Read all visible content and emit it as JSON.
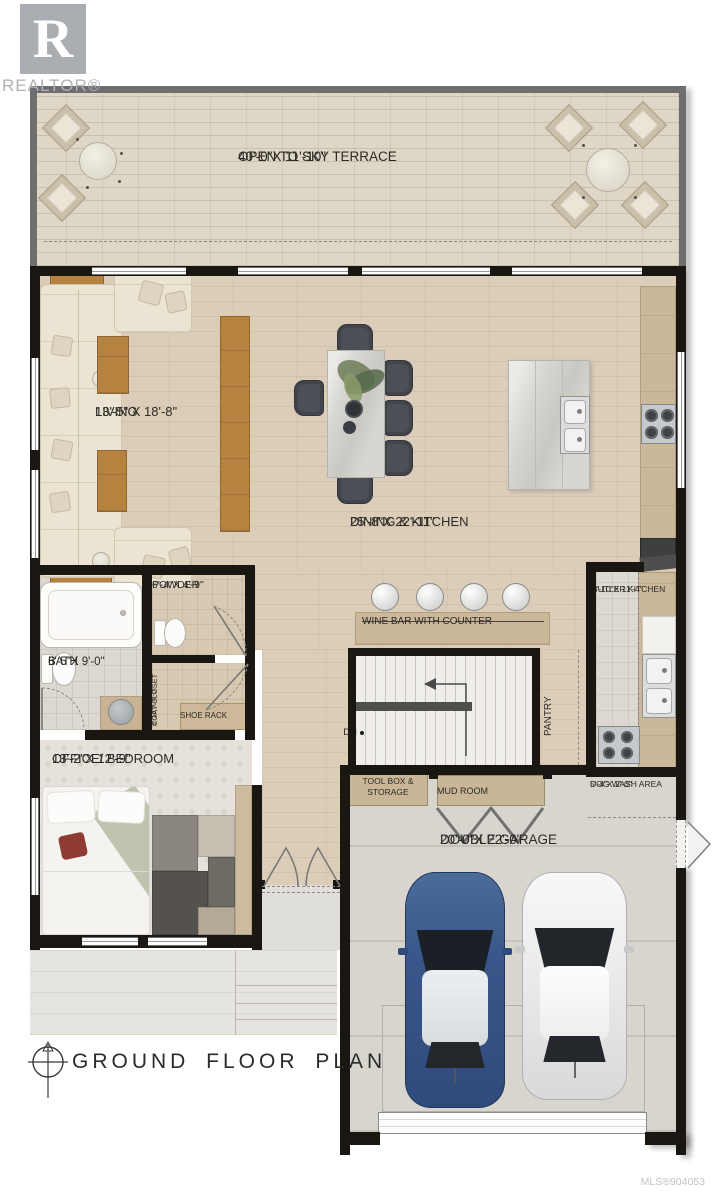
{
  "branding": {
    "logo_letter": "R",
    "realtor_text": "REALTOR®",
    "mls_text": "MLS®904053"
  },
  "title": {
    "plan_name": "GROUND FLOOR PLAN"
  },
  "rooms": {
    "terrace": {
      "name": "OPEN TO SKY TERRACE",
      "dims": "40'-0\"X 11'-10\""
    },
    "living": {
      "name": "LIVING",
      "dims": "13'-5\" X 18'-8\""
    },
    "dining_kitchen": {
      "name": "DINING & KITCHEN",
      "dims": "25'-8\"X 22'-11\""
    },
    "powder": {
      "name": "POWDER",
      "dims": "6'-4\"X 4'-9\""
    },
    "bath": {
      "name": "BATH",
      "dims": "6'-5\"X 9'-0\""
    },
    "coat_closet": {
      "name": "COAT CLOSET",
      "dims": "3'-10\"X 4'-0\""
    },
    "shoe_rack": {
      "name": "SHOE RACK"
    },
    "wine_bar": {
      "name": "WINE BAR WITH COUNTER"
    },
    "stairs": {
      "down_label": "DN"
    },
    "pantry": {
      "name": "PANTRY"
    },
    "butler_kitchen": {
      "name": "BUTLER KITCHEN",
      "dims": "4'-10\"X 11'-4\""
    },
    "dog_wash": {
      "name": "DOG WASH AREA",
      "dims": "5'-4\"X 2'-0\""
    },
    "office_bedroom": {
      "name": "OFFICE/ BEDROOM",
      "dims": "13'-2\"X 12'-9\""
    },
    "tool_box": {
      "name": "TOOL BOX & STORAGE"
    },
    "mud_room": {
      "name": "MUD ROOM"
    },
    "garage": {
      "name": "DOUBLE GARAGE",
      "dims": "20'-0\"X 22'-0\""
    }
  },
  "colors": {
    "wall": "#1a1713",
    "wood_floor": "#dccdb9",
    "terrace_floor": "#ded6c6",
    "tile_floor": "#ddd9d1",
    "garage_floor": "#d8d5ce",
    "counter_tan": "#cbb89a",
    "wood_furniture": "#b5823f",
    "sofa_cream": "#ece4d3",
    "dining_chair": "#4c5056",
    "car_blue": "#39578a",
    "car_white": "#f0f0f0",
    "logo_gray": "#a3a7ab",
    "label_text": "#2c2a27"
  }
}
